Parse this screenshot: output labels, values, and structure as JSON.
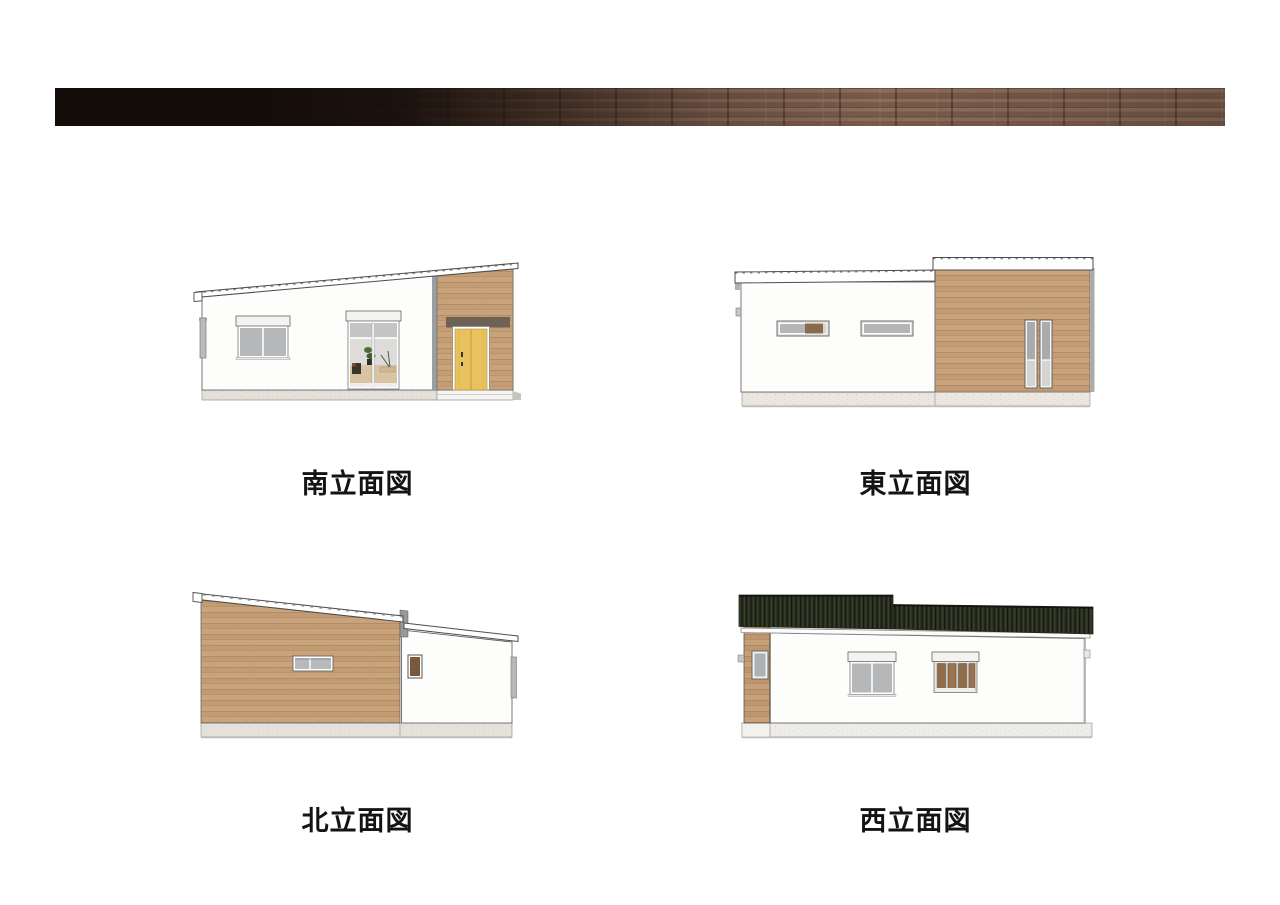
{
  "sheet": {
    "background": "#ffffff"
  },
  "banner": {
    "name": "brick-facade-strip",
    "left_color": "#140c08",
    "right_brick_color": "#8b6c59"
  },
  "elevations": [
    {
      "id": "south",
      "label": "南立面図"
    },
    {
      "id": "east",
      "label": "東立面図"
    },
    {
      "id": "north",
      "label": "北立面図"
    },
    {
      "id": "west",
      "label": "西立面図"
    }
  ],
  "colors": {
    "wall_white": "#fdfdfc",
    "wood_siding": "#c9a37c",
    "wood_plank_line": "#ad8660",
    "entry_door": "#e9c25e",
    "door_lintel": "#6e6156",
    "window_glass": "#b5b7b9",
    "shutter_box": "#f4f3f1",
    "slot_window_wood_panel": "#8a6b4d",
    "west_roof_dark": "#2b2f20",
    "foundation": "#e5e1da",
    "outline": "#4d4d4d",
    "label_text": "#141414"
  }
}
